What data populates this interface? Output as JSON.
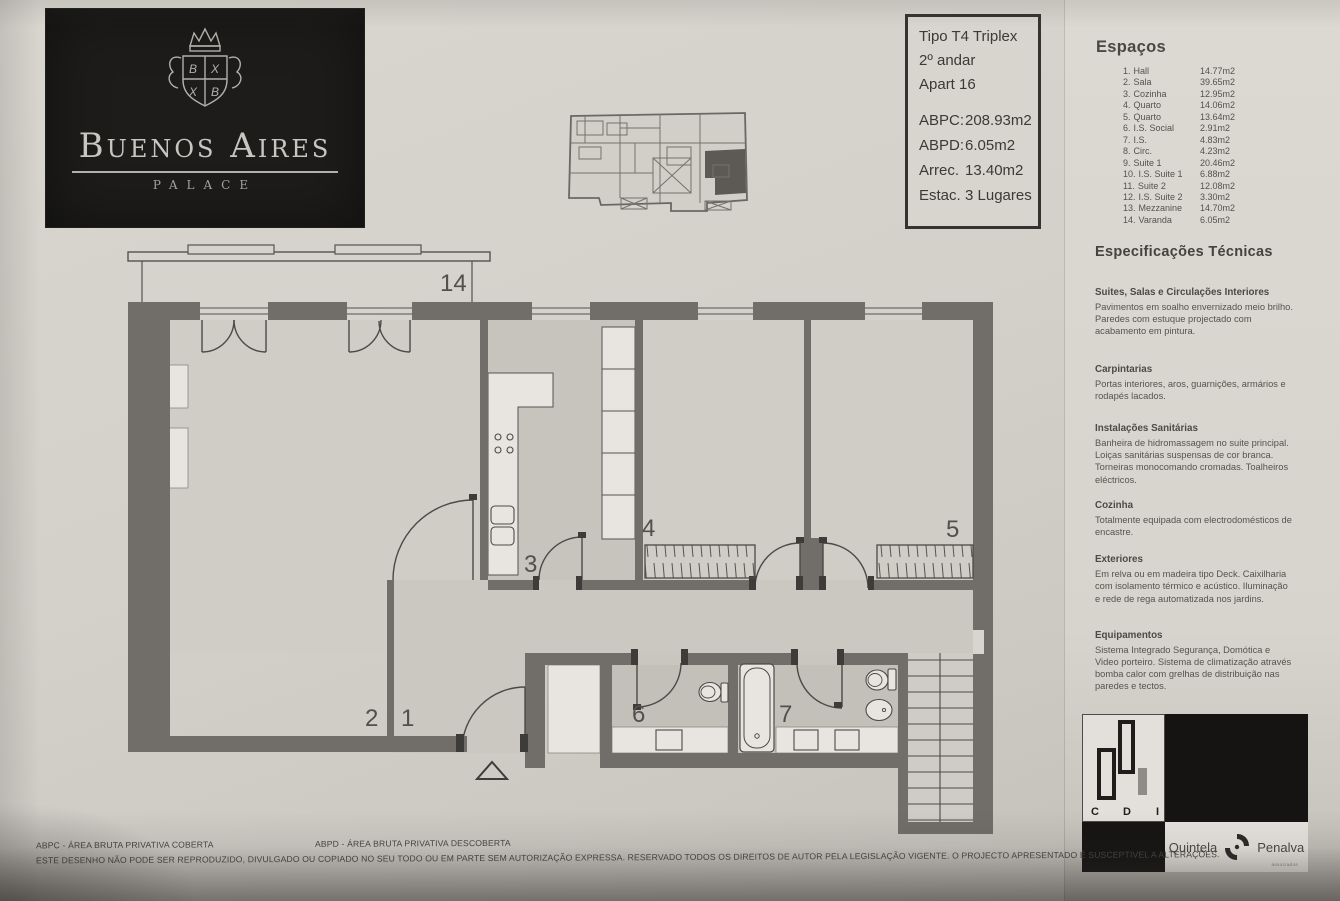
{
  "brand": {
    "title": "Buenos Aires",
    "subtitle": "PALACE"
  },
  "info_box": {
    "lines": [
      "Tipo T4 Triplex",
      "2º andar",
      "Apart 16"
    ],
    "metrics": [
      {
        "label": "ABPC:",
        "value": "208.93m2"
      },
      {
        "label": "ABPD:",
        "value": "6.05m2"
      },
      {
        "label": "Arrec.",
        "value": "13.40m2"
      },
      {
        "label": "Estac.",
        "value": "3 Lugares"
      }
    ]
  },
  "espacos": {
    "title": "Espaços",
    "items": [
      {
        "num": "1.",
        "name": "Hall",
        "area": "14.77m2"
      },
      {
        "num": "2.",
        "name": "Sala",
        "area": "39.65m2"
      },
      {
        "num": "3.",
        "name": "Cozinha",
        "area": "12.95m2"
      },
      {
        "num": "4.",
        "name": "Quarto",
        "area": "14.06m2"
      },
      {
        "num": "5.",
        "name": "Quarto",
        "area": "13.64m2"
      },
      {
        "num": "6.",
        "name": "I.S. Social",
        "area": "2.91m2"
      },
      {
        "num": "7.",
        "name": "I.S.",
        "area": "4.83m2"
      },
      {
        "num": "8.",
        "name": "Circ.",
        "area": "4.23m2"
      },
      {
        "num": "9.",
        "name": "Suite 1",
        "area": "20.46m2"
      },
      {
        "num": "10.",
        "name": "I.S. Suite 1",
        "area": "6.88m2"
      },
      {
        "num": "11.",
        "name": "Suite 2",
        "area": "12.08m2"
      },
      {
        "num": "12.",
        "name": "I.S. Suite 2",
        "area": "3.30m2"
      },
      {
        "num": "13.",
        "name": "Mezzanine",
        "area": "14.70m2"
      },
      {
        "num": "14.",
        "name": "Varanda",
        "area": "6.05m2"
      }
    ]
  },
  "spec": {
    "title": "Especificações Técnicas",
    "sections": [
      {
        "heading": "Suites, Salas e Circulações Interiores",
        "body": "Pavimentos em soalho envernizado meio brilho. Paredes com estuque projectado com acabamento em pintura."
      },
      {
        "heading": "Carpintarias",
        "body": "Portas interiores, aros, guarnições, armários e rodapés lacados."
      },
      {
        "heading": "Instalações Sanitárias",
        "body": "Banheira de hidromassagem no suite principal. Loiças sanitárias suspensas de cor branca. Torneiras monocomando cromadas. Toalheiros eléctricos."
      },
      {
        "heading": "Cozinha",
        "body": "Totalmente equipada com electrodomésticos de encastre."
      },
      {
        "heading": "Exteriores",
        "body": "Em relva ou em madeira tipo Deck. Caixilharia com isolamento térmico e acústico. Iluminação e rede de rega automatizada nos jardins."
      },
      {
        "heading": "Equipamentos",
        "body": "Sistema Integrado Segurança, Domótica e Video porteiro. Sistema de climatização através bomba calor com grelhas de distribuição nas paredes e tectos."
      }
    ]
  },
  "plan": {
    "labels": [
      "14",
      "2",
      "1",
      "3",
      "4",
      "5",
      "6",
      "7"
    ]
  },
  "logos": {
    "cdi_letters": [
      "C",
      "D",
      "I"
    ],
    "quintela": "Quintela",
    "penalva": "Penalva",
    "sub": "associados"
  },
  "footer": {
    "abpc": "ABPC - ÁREA BRUTA PRIVATIVA COBERTA",
    "abpd": "ABPD - ÁREA BRUTA PRIVATIVA DESCOBERTA",
    "notice": "ESTE DESENHO NÃO PODE SER REPRODUZIDO, DIVULGADO OU COPIADO NO SEU TODO OU EM PARTE SEM AUTORIZAÇÃO EXPRESSA. RESERVADO TODOS OS DIREITOS DE AUTOR PELA LEGISLAÇÃO VIGENTE. O PROJECTO APRESENTADO É SUSCEPTIVEL A ALTERAÇÕES."
  },
  "colors": {
    "wall": "#716d68",
    "ink": "#4c4a46",
    "paper": "#d4d0ca",
    "bath_floor": "#c3bfb9",
    "highlight_unit": "#5d5a56",
    "brand_bg": "#1d1c1b"
  }
}
